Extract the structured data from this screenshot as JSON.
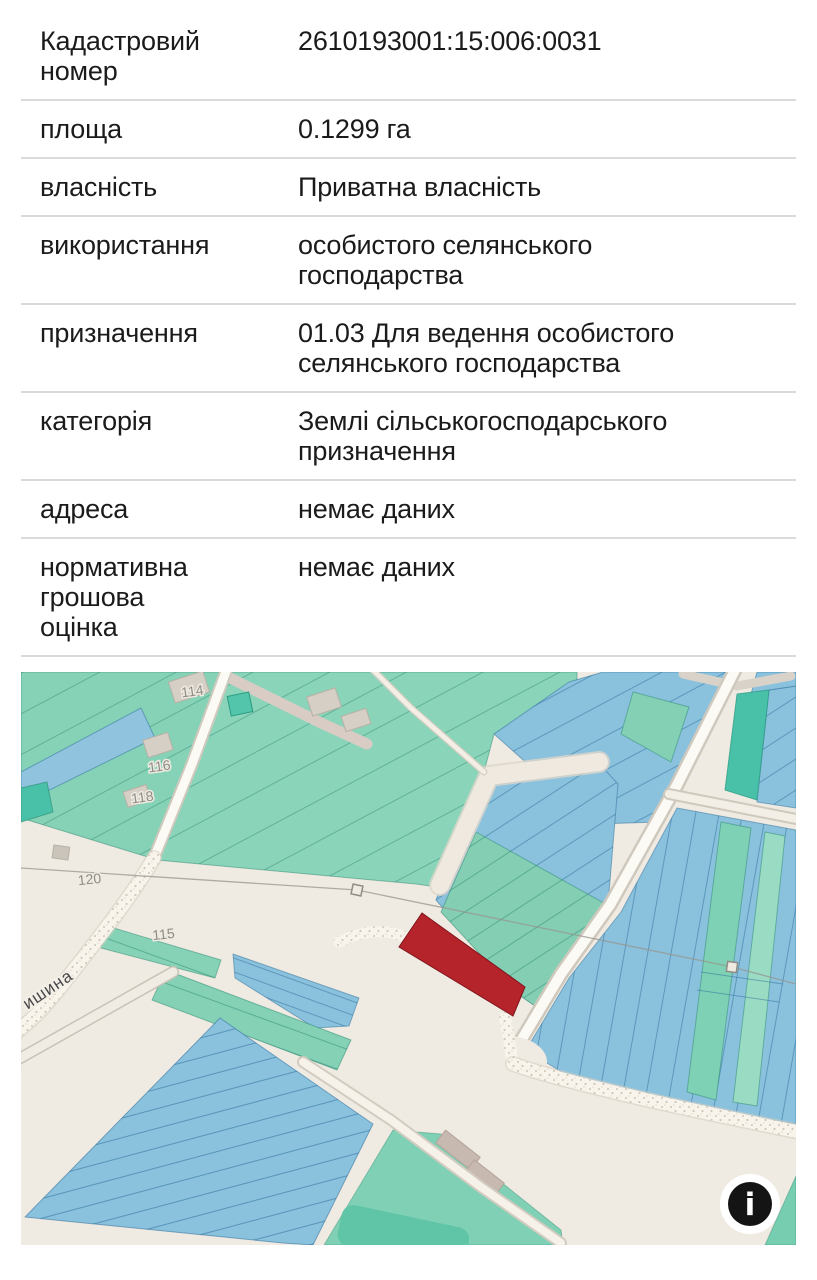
{
  "table": {
    "rows": [
      {
        "label": "Кадастровий номер",
        "value": "2610193001:15:006:0031"
      },
      {
        "label": "площа",
        "value": "0.1299 га"
      },
      {
        "label": "власність",
        "value": "Приватна власність"
      },
      {
        "label": "використання",
        "value": "особистого селянського господарства"
      },
      {
        "label": "призначення",
        "value": "01.03 Для ведення особистого селянського господарства"
      },
      {
        "label": "категорія",
        "value": "Землі сільськогосподарського призначення"
      },
      {
        "label": "адреса",
        "value": "немає даних"
      },
      {
        "label": "нормативна грошова оцінка",
        "value": "немає даних"
      }
    ]
  },
  "map": {
    "parcel_labels": [
      "114",
      "116",
      "118",
      "120",
      "115"
    ],
    "street_label": "ишина",
    "info_button_glyph": "i",
    "selected_parcel": {
      "cadastral_number": "2610193001:15:006:0031",
      "color": "#b5232b"
    },
    "colors": {
      "background": "#f0ebe2",
      "parcel_green": "#86d2b7",
      "parcel_green_dark": "#4cc3aa",
      "parcel_blue": "#8ac1dd",
      "selected_red": "#b5232b",
      "road_fill": "#fcfaf5",
      "road_casing": "#cfc8bd",
      "separator": "#dadada",
      "text": "#1b1b1b"
    }
  }
}
